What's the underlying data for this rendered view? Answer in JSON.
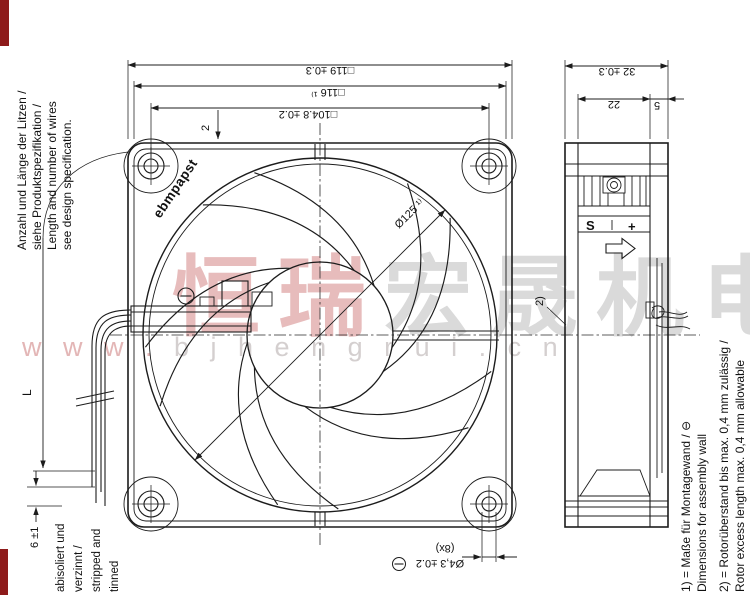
{
  "colors": {
    "line": "#1c1c1c",
    "red_bar": "#8e1b1b",
    "watermark_pink": "#e7bcbc",
    "watermark_gray": "#dadada",
    "url_pink": "#e3b6b6",
    "url_gray": "#d4cfcf"
  },
  "watermark": {
    "cn_pink": "恒瑞",
    "cn_gray": "宏晟机电",
    "url_pink": "w w w .",
    "url_gray": " b j h e n g r u i . c n"
  },
  "left_note": {
    "line1": "Anzahl und Länge der Litzen /",
    "line2": "siehe Produktspezifikation /",
    "line3": "Length and number of wires",
    "line4": "see design specification."
  },
  "front_view": {
    "logo": "ebmpapst",
    "dim_size": "□119 ±0.3",
    "dim_mount_ref": "□116 ¹⁾",
    "dim_holes": "□104.8 ±0.2",
    "dim_thickness": "2",
    "dim_venturi": "Ø125 ¹⁾"
  },
  "side_view": {
    "dim_depth": "32 ±0.3",
    "dim_body": "22",
    "dim_rotor": "5",
    "rotor_ref": "2)",
    "terminal_s": "S",
    "terminal_plus": "+"
  },
  "leads": {
    "length_label": "L",
    "strip_dim": "6 ±1",
    "strip_note_de1": "abisoliert und",
    "strip_note_de2": "verzinnt /",
    "strip_note_en1": "stripped and",
    "strip_note_en2": "tinned"
  },
  "mounting_hole": {
    "dim": "Ø4,3 ±0.2",
    "count": "(8x)"
  },
  "footnotes": {
    "n1_de": "1) = Maße für Montagewand / ⊖",
    "n1_en": "Dimensions for assembly wall",
    "n2_de": "2) = Rotorüberstand bis max. 0,4 mm zulässig /",
    "n2_en": "Rotor excess length max. 0,4 mm allowable"
  }
}
